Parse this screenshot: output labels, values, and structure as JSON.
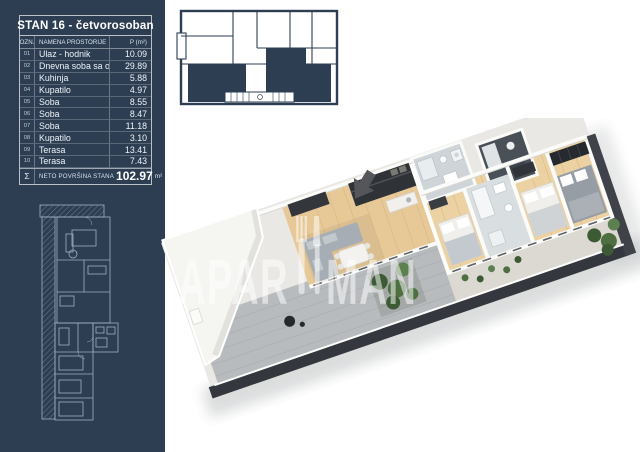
{
  "panel": {
    "title": "STAN 16 - četvorosoban",
    "table": {
      "col_ozn": "OZN.",
      "col_name": "NAMENA PROSTORIJE",
      "col_area": "P (m²)",
      "rows": [
        {
          "ozn": "01",
          "name": "Ulaz - hodnik",
          "area": "10.09"
        },
        {
          "ozn": "02",
          "name": "Dnevna soba sa obed.",
          "area": "29.89"
        },
        {
          "ozn": "03",
          "name": "Kuhinja",
          "area": "5.88"
        },
        {
          "ozn": "04",
          "name": "Kupatilo",
          "area": "4.97"
        },
        {
          "ozn": "05",
          "name": "Soba",
          "area": "8.55"
        },
        {
          "ozn": "06",
          "name": "Soba",
          "area": "8.47"
        },
        {
          "ozn": "07",
          "name": "Soba",
          "area": "11.18"
        },
        {
          "ozn": "08",
          "name": "Kupatilo",
          "area": "3.10"
        },
        {
          "ozn": "09",
          "name": "Terasa",
          "area": "13.41"
        },
        {
          "ozn": "10",
          "name": "Terasa",
          "area": "7.43"
        }
      ],
      "sum_symbol": "Σ",
      "sum_label": "NETO POVRŠINA STANA",
      "sum_value": "102.97",
      "sum_unit": "m²"
    }
  },
  "watermark": {
    "left": "APAR",
    "right": "MAN",
    "full_brand": "APARTMAN"
  },
  "colors": {
    "panel_navy": "#2d3e53",
    "blueprint_line": "#9db0c2",
    "wood_floor": "#e7c897",
    "terrace_gray": "#b7bbbd",
    "slab_dark": "#34383e",
    "greenery": "#4e7040",
    "arrow_gray": "#55565a"
  }
}
